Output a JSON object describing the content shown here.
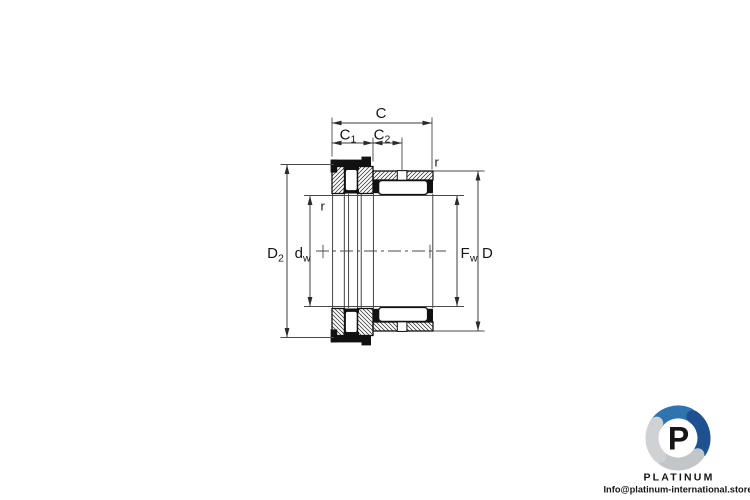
{
  "page": {
    "background": "#ffffff"
  },
  "drawing": {
    "kind": "combined needle roller bearing cross-section",
    "labels": {
      "c": "C",
      "c1": {
        "main": "C",
        "sub": "1"
      },
      "c2": {
        "main": "C",
        "sub": "2"
      },
      "d2": {
        "main": "D",
        "sub": "2"
      },
      "dw": {
        "main": "d",
        "sub": "w"
      },
      "fw": {
        "main": "F",
        "sub": "w"
      },
      "d": "D",
      "r_left": "r",
      "r_right": "r"
    },
    "colors": {
      "outline": "#121212",
      "dimension": "#3c3c3c",
      "hatch": "#2b2b2b"
    }
  },
  "branding": {
    "monogram": "P",
    "wordmark": "PLATINUM",
    "email": "Info@platinum-international.store",
    "colors": {
      "blue": "#2e74ae",
      "navy": "#1d5190",
      "gray": "#c3c6c9",
      "light_gray": "#cfd1d4",
      "text": "#1c3c68"
    }
  }
}
